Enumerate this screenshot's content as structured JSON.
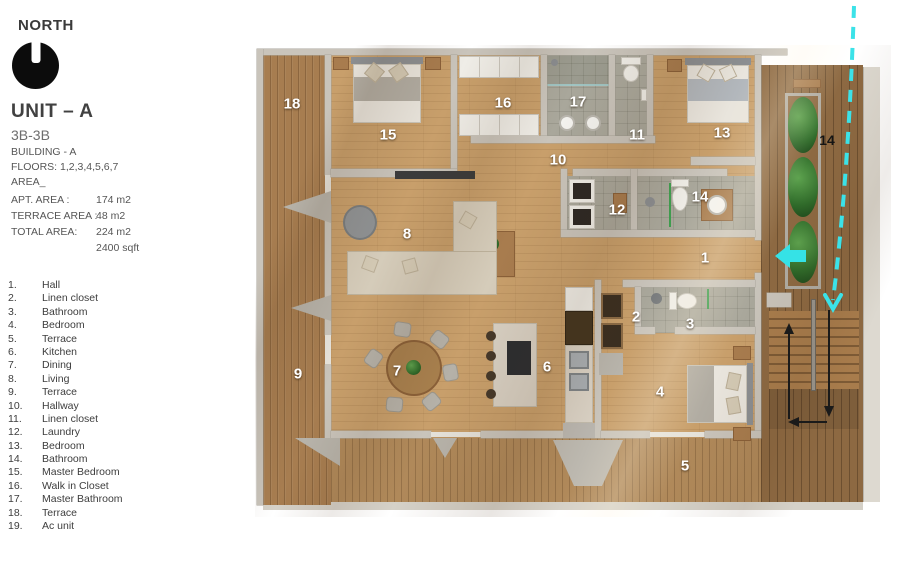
{
  "header": {
    "north_label": "NORTH",
    "unit_title": "UNIT – A",
    "unit_subtitle": "3B-3B",
    "building": "BUILDING - A",
    "floors": "FLOORS: 1,2,3,4,5,6,7",
    "area_heading": "AREA_",
    "area_rows": [
      {
        "label": "APT. AREA :",
        "value": "174 m2"
      },
      {
        "label": "TERRACE AREA :",
        "value": "48 m2"
      },
      {
        "label": "TOTAL AREA:",
        "value": "224 m2"
      },
      {
        "label": "",
        "value": "2400 sqft"
      }
    ]
  },
  "legend": {
    "items": [
      {
        "num": "1.",
        "name": "Hall"
      },
      {
        "num": "2.",
        "name": "Linen closet"
      },
      {
        "num": "3.",
        "name": "Bathroom"
      },
      {
        "num": "4.",
        "name": "Bedroom"
      },
      {
        "num": "5.",
        "name": "Terrace"
      },
      {
        "num": "6.",
        "name": "Kitchen"
      },
      {
        "num": "7.",
        "name": "Dining"
      },
      {
        "num": "8.",
        "name": "Living"
      },
      {
        "num": "9.",
        "name": "Terrace"
      },
      {
        "num": "10.",
        "name": "Hallway"
      },
      {
        "num": "11.",
        "name": "Linen closet"
      },
      {
        "num": "12.",
        "name": "Laundry"
      },
      {
        "num": "13.",
        "name": "Bedroom"
      },
      {
        "num": "14.",
        "name": "Bathroom"
      },
      {
        "num": "15.",
        "name": "Master Bedroom"
      },
      {
        "num": "16.",
        "name": "Walk in Closet"
      },
      {
        "num": "17.",
        "name": "Master Bathroom"
      },
      {
        "num": "18.",
        "name": "Terrace"
      },
      {
        "num": "19.",
        "name": "Ac unit"
      }
    ]
  },
  "plan": {
    "room_labels": {
      "hall": "1",
      "linen_closet_a": "2",
      "bathroom_a": "3",
      "bedroom_a": "4",
      "terrace_a": "5",
      "kitchen": "6",
      "dining": "7",
      "living": "8",
      "terrace_b": "9",
      "hallway": "10",
      "linen_closet_b": "11",
      "laundry": "12",
      "bedroom_b": "13",
      "bathroom_b": "14",
      "master_bedroom": "15",
      "walk_in_closet": "16",
      "master_bathroom": "17",
      "terrace_c": "18",
      "deck_extra": "14"
    },
    "colors": {
      "accent_cyan": "#3BE2E8",
      "wood_floor": "#C89F6B",
      "deck_wood": "#8D6942",
      "wall": "#C9C4BB",
      "tile": "#A9A79B"
    }
  }
}
